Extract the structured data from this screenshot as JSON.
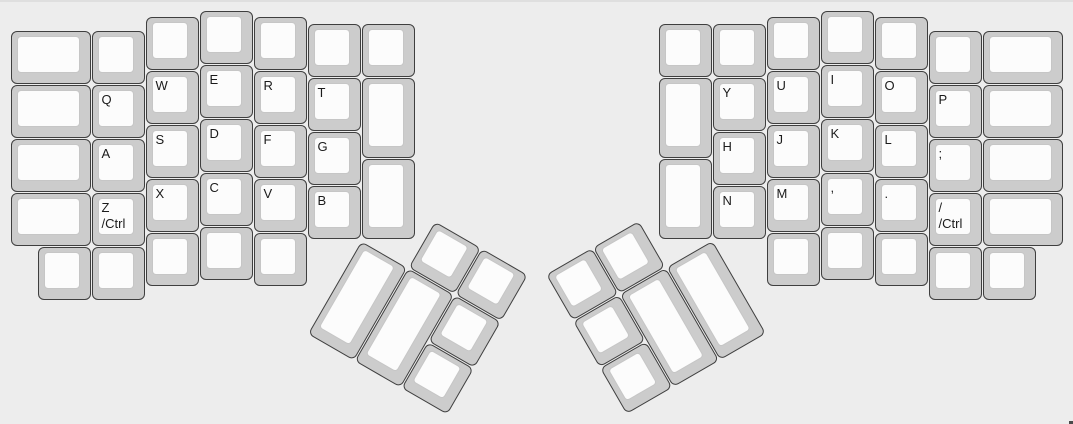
{
  "canvas": {
    "width_px": 1073,
    "height_px": 424,
    "background": "#ededed",
    "top_edge_color": "#dfdfdf",
    "corner_mark_color": "#4a4a4a"
  },
  "keyboard": {
    "name": "ergodox-split-layout",
    "unit_px": 54,
    "margin_px": 10,
    "colors": {
      "cap_border": "#3f3f3f",
      "cap_base": "#cccccc",
      "cap_top": "#fcfcfc",
      "cap_top_border": "#c6c6c6",
      "legend": "#1b1b1b"
    },
    "main_keys": [
      {
        "id": "key-blank",
        "x": 0,
        "y": 0.375,
        "w": 1.5,
        "h": 1,
        "legend": []
      },
      {
        "id": "key-blank",
        "x": 0,
        "y": 1.375,
        "w": 1.5,
        "h": 1,
        "legend": []
      },
      {
        "id": "key-blank",
        "x": 0,
        "y": 2.375,
        "w": 1.5,
        "h": 1,
        "legend": []
      },
      {
        "id": "key-blank",
        "x": 0,
        "y": 3.375,
        "w": 1.5,
        "h": 1,
        "legend": []
      },
      {
        "id": "key-blank",
        "x": 1.5,
        "y": 0.375,
        "w": 1,
        "h": 1,
        "legend": []
      },
      {
        "id": "key-q",
        "x": 1.5,
        "y": 1.375,
        "w": 1,
        "h": 1,
        "legend": [
          "Q"
        ]
      },
      {
        "id": "key-a",
        "x": 1.5,
        "y": 2.375,
        "w": 1,
        "h": 1,
        "legend": [
          "A"
        ]
      },
      {
        "id": "key-z-ctrl",
        "x": 1.5,
        "y": 3.375,
        "w": 1,
        "h": 1,
        "legend": [
          "Z",
          "/Ctrl"
        ]
      },
      {
        "id": "key-blank",
        "x": 2.5,
        "y": 0.125,
        "w": 1,
        "h": 1,
        "legend": []
      },
      {
        "id": "key-w",
        "x": 2.5,
        "y": 1.125,
        "w": 1,
        "h": 1,
        "legend": [
          "W"
        ]
      },
      {
        "id": "key-s",
        "x": 2.5,
        "y": 2.125,
        "w": 1,
        "h": 1,
        "legend": [
          "S"
        ]
      },
      {
        "id": "key-x",
        "x": 2.5,
        "y": 3.125,
        "w": 1,
        "h": 1,
        "legend": [
          "X"
        ]
      },
      {
        "id": "key-blank",
        "x": 3.5,
        "y": 0,
        "w": 1,
        "h": 1,
        "legend": []
      },
      {
        "id": "key-e",
        "x": 3.5,
        "y": 1,
        "w": 1,
        "h": 1,
        "legend": [
          "E"
        ]
      },
      {
        "id": "key-d",
        "x": 3.5,
        "y": 2,
        "w": 1,
        "h": 1,
        "legend": [
          "D"
        ]
      },
      {
        "id": "key-c",
        "x": 3.5,
        "y": 3,
        "w": 1,
        "h": 1,
        "legend": [
          "C"
        ]
      },
      {
        "id": "key-blank",
        "x": 4.5,
        "y": 0.125,
        "w": 1,
        "h": 1,
        "legend": []
      },
      {
        "id": "key-r",
        "x": 4.5,
        "y": 1.125,
        "w": 1,
        "h": 1,
        "legend": [
          "R"
        ]
      },
      {
        "id": "key-f",
        "x": 4.5,
        "y": 2.125,
        "w": 1,
        "h": 1,
        "legend": [
          "F"
        ]
      },
      {
        "id": "key-v",
        "x": 4.5,
        "y": 3.125,
        "w": 1,
        "h": 1,
        "legend": [
          "V"
        ]
      },
      {
        "id": "key-blank",
        "x": 5.5,
        "y": 0.25,
        "w": 1,
        "h": 1,
        "legend": []
      },
      {
        "id": "key-t",
        "x": 5.5,
        "y": 1.25,
        "w": 1,
        "h": 1,
        "legend": [
          "T"
        ]
      },
      {
        "id": "key-g",
        "x": 5.5,
        "y": 2.25,
        "w": 1,
        "h": 1,
        "legend": [
          "G"
        ]
      },
      {
        "id": "key-b",
        "x": 5.5,
        "y": 3.25,
        "w": 1,
        "h": 1,
        "legend": [
          "B"
        ]
      },
      {
        "id": "key-blank",
        "x": 6.5,
        "y": 0.25,
        "w": 1,
        "h": 1,
        "legend": []
      },
      {
        "id": "key-blank",
        "x": 6.5,
        "y": 1.25,
        "w": 1,
        "h": 1.5,
        "legend": []
      },
      {
        "id": "key-blank",
        "x": 6.5,
        "y": 2.75,
        "w": 1,
        "h": 1.5,
        "legend": []
      },
      {
        "id": "key-blank",
        "x": 0.5,
        "y": 4.375,
        "w": 1,
        "h": 1,
        "legend": []
      },
      {
        "id": "key-blank",
        "x": 1.5,
        "y": 4.375,
        "w": 1,
        "h": 1,
        "legend": []
      },
      {
        "id": "key-blank",
        "x": 2.5,
        "y": 4.125,
        "w": 1,
        "h": 1,
        "legend": []
      },
      {
        "id": "key-blank",
        "x": 3.5,
        "y": 4,
        "w": 1,
        "h": 1,
        "legend": []
      },
      {
        "id": "key-blank",
        "x": 4.5,
        "y": 4.125,
        "w": 1,
        "h": 1,
        "legend": []
      },
      {
        "id": "key-blank",
        "x": 12,
        "y": 0.25,
        "w": 1,
        "h": 1,
        "legend": []
      },
      {
        "id": "key-blank",
        "x": 12,
        "y": 1.25,
        "w": 1,
        "h": 1.5,
        "legend": []
      },
      {
        "id": "key-blank",
        "x": 12,
        "y": 2.75,
        "w": 1,
        "h": 1.5,
        "legend": []
      },
      {
        "id": "key-blank",
        "x": 13,
        "y": 0.25,
        "w": 1,
        "h": 1,
        "legend": []
      },
      {
        "id": "key-y",
        "x": 13,
        "y": 1.25,
        "w": 1,
        "h": 1,
        "legend": [
          "Y"
        ]
      },
      {
        "id": "key-h",
        "x": 13,
        "y": 2.25,
        "w": 1,
        "h": 1,
        "legend": [
          "H"
        ]
      },
      {
        "id": "key-n",
        "x": 13,
        "y": 3.25,
        "w": 1,
        "h": 1,
        "legend": [
          "N"
        ]
      },
      {
        "id": "key-blank",
        "x": 14,
        "y": 0.125,
        "w": 1,
        "h": 1,
        "legend": []
      },
      {
        "id": "key-u",
        "x": 14,
        "y": 1.125,
        "w": 1,
        "h": 1,
        "legend": [
          "U"
        ]
      },
      {
        "id": "key-j",
        "x": 14,
        "y": 2.125,
        "w": 1,
        "h": 1,
        "legend": [
          "J"
        ]
      },
      {
        "id": "key-m",
        "x": 14,
        "y": 3.125,
        "w": 1,
        "h": 1,
        "legend": [
          "M"
        ]
      },
      {
        "id": "key-blank",
        "x": 15,
        "y": 0,
        "w": 1,
        "h": 1,
        "legend": []
      },
      {
        "id": "key-i",
        "x": 15,
        "y": 1,
        "w": 1,
        "h": 1,
        "legend": [
          "I"
        ]
      },
      {
        "id": "key-k",
        "x": 15,
        "y": 2,
        "w": 1,
        "h": 1,
        "legend": [
          "K"
        ]
      },
      {
        "id": "key-comma",
        "x": 15,
        "y": 3,
        "w": 1,
        "h": 1,
        "legend": [
          ","
        ]
      },
      {
        "id": "key-blank",
        "x": 16,
        "y": 0.125,
        "w": 1,
        "h": 1,
        "legend": []
      },
      {
        "id": "key-o",
        "x": 16,
        "y": 1.125,
        "w": 1,
        "h": 1,
        "legend": [
          "O"
        ]
      },
      {
        "id": "key-l",
        "x": 16,
        "y": 2.125,
        "w": 1,
        "h": 1,
        "legend": [
          "L"
        ]
      },
      {
        "id": "key-period",
        "x": 16,
        "y": 3.125,
        "w": 1,
        "h": 1,
        "legend": [
          "."
        ]
      },
      {
        "id": "key-blank",
        "x": 17,
        "y": 0.375,
        "w": 1,
        "h": 1,
        "legend": []
      },
      {
        "id": "key-p",
        "x": 17,
        "y": 1.375,
        "w": 1,
        "h": 1,
        "legend": [
          "P"
        ]
      },
      {
        "id": "key-semicolon",
        "x": 17,
        "y": 2.375,
        "w": 1,
        "h": 1,
        "legend": [
          ";"
        ]
      },
      {
        "id": "key-slash-ctrl",
        "x": 17,
        "y": 3.375,
        "w": 1,
        "h": 1,
        "legend": [
          "/",
          "/Ctrl"
        ]
      },
      {
        "id": "key-blank",
        "x": 18,
        "y": 0.375,
        "w": 1.5,
        "h": 1,
        "legend": []
      },
      {
        "id": "key-blank",
        "x": 18,
        "y": 1.375,
        "w": 1.5,
        "h": 1,
        "legend": []
      },
      {
        "id": "key-blank",
        "x": 18,
        "y": 2.375,
        "w": 1.5,
        "h": 1,
        "legend": []
      },
      {
        "id": "key-blank",
        "x": 18,
        "y": 3.375,
        "w": 1.5,
        "h": 1,
        "legend": []
      },
      {
        "id": "key-blank",
        "x": 14,
        "y": 4.125,
        "w": 1,
        "h": 1,
        "legend": []
      },
      {
        "id": "key-blank",
        "x": 15,
        "y": 4,
        "w": 1,
        "h": 1,
        "legend": []
      },
      {
        "id": "key-blank",
        "x": 16,
        "y": 4.125,
        "w": 1,
        "h": 1,
        "legend": []
      },
      {
        "id": "key-blank",
        "x": 17,
        "y": 4.375,
        "w": 1,
        "h": 1,
        "legend": []
      },
      {
        "id": "key-blank",
        "x": 18,
        "y": 4.375,
        "w": 1,
        "h": 1,
        "legend": []
      }
    ],
    "thumb_clusters": [
      {
        "name": "left-thumb-cluster",
        "rx": 6.5,
        "ry": 4.25,
        "angle": 30,
        "keys": [
          {
            "id": "thumb-key-blank",
            "x": 1,
            "y": -1,
            "w": 1,
            "h": 1,
            "legend": []
          },
          {
            "id": "thumb-key-blank",
            "x": 2,
            "y": -1,
            "w": 1,
            "h": 1,
            "legend": []
          },
          {
            "id": "thumb-key-blank",
            "x": 0,
            "y": 0,
            "w": 1,
            "h": 2,
            "legend": []
          },
          {
            "id": "thumb-key-blank",
            "x": 1,
            "y": 0,
            "w": 1,
            "h": 2,
            "legend": []
          },
          {
            "id": "thumb-key-blank",
            "x": 2,
            "y": 0,
            "w": 1,
            "h": 1,
            "legend": []
          },
          {
            "id": "thumb-key-blank",
            "x": 2,
            "y": 1,
            "w": 1,
            "h": 1,
            "legend": []
          }
        ]
      },
      {
        "name": "right-thumb-cluster",
        "rx": 13,
        "ry": 4.25,
        "angle": -30,
        "keys": [
          {
            "id": "thumb-key-blank",
            "x": -3,
            "y": -1,
            "w": 1,
            "h": 1,
            "legend": []
          },
          {
            "id": "thumb-key-blank",
            "x": -2,
            "y": -1,
            "w": 1,
            "h": 1,
            "legend": []
          },
          {
            "id": "thumb-key-blank",
            "x": -3,
            "y": 0,
            "w": 1,
            "h": 1,
            "legend": []
          },
          {
            "id": "thumb-key-blank",
            "x": -2,
            "y": 0,
            "w": 1,
            "h": 2,
            "legend": []
          },
          {
            "id": "thumb-key-blank",
            "x": -1,
            "y": 0,
            "w": 1,
            "h": 2,
            "legend": []
          },
          {
            "id": "thumb-key-blank",
            "x": -3,
            "y": 1,
            "w": 1,
            "h": 1,
            "legend": []
          }
        ]
      }
    ]
  }
}
